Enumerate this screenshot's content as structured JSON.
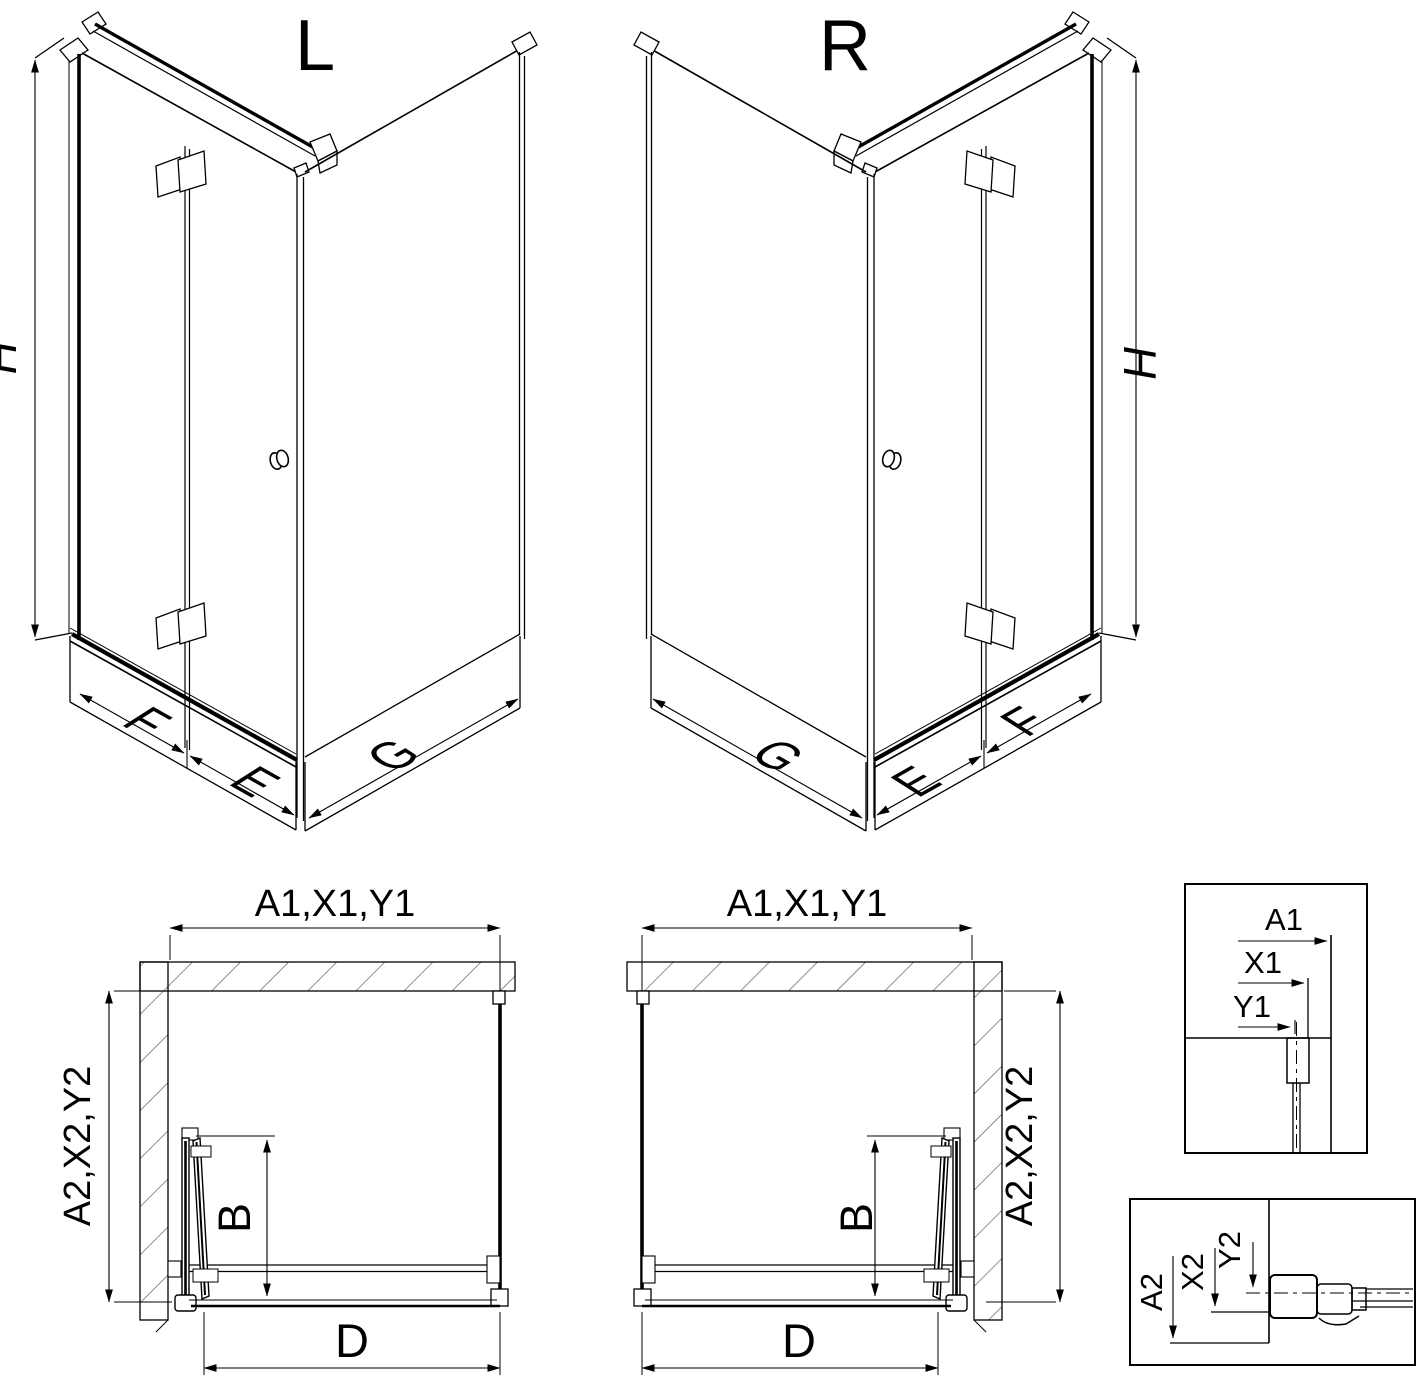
{
  "colors": {
    "background": "#ffffff",
    "line": "#000000"
  },
  "iso_left": {
    "title": "L",
    "labels": {
      "h": "H",
      "f": "F",
      "e": "E",
      "g": "G"
    }
  },
  "iso_right": {
    "title": "R",
    "labels": {
      "h": "H",
      "f": "F",
      "e": "E",
      "g": "G"
    }
  },
  "plan_left": {
    "dim_width": "A1,X1,Y1",
    "dim_depth": "A2,X2,Y2",
    "dim_fold": "B",
    "dim_entry": "D"
  },
  "plan_right": {
    "dim_width": "A1,X1,Y1",
    "dim_depth": "A2,X2,Y2",
    "dim_fold": "B",
    "dim_entry": "D"
  },
  "detail_width": {
    "dim_outer": "A1",
    "dim_mid": "X1",
    "dim_inner": "Y1"
  },
  "detail_depth": {
    "dim_outer": "A2",
    "dim_mid": "X2",
    "dim_inner": "Y2"
  }
}
